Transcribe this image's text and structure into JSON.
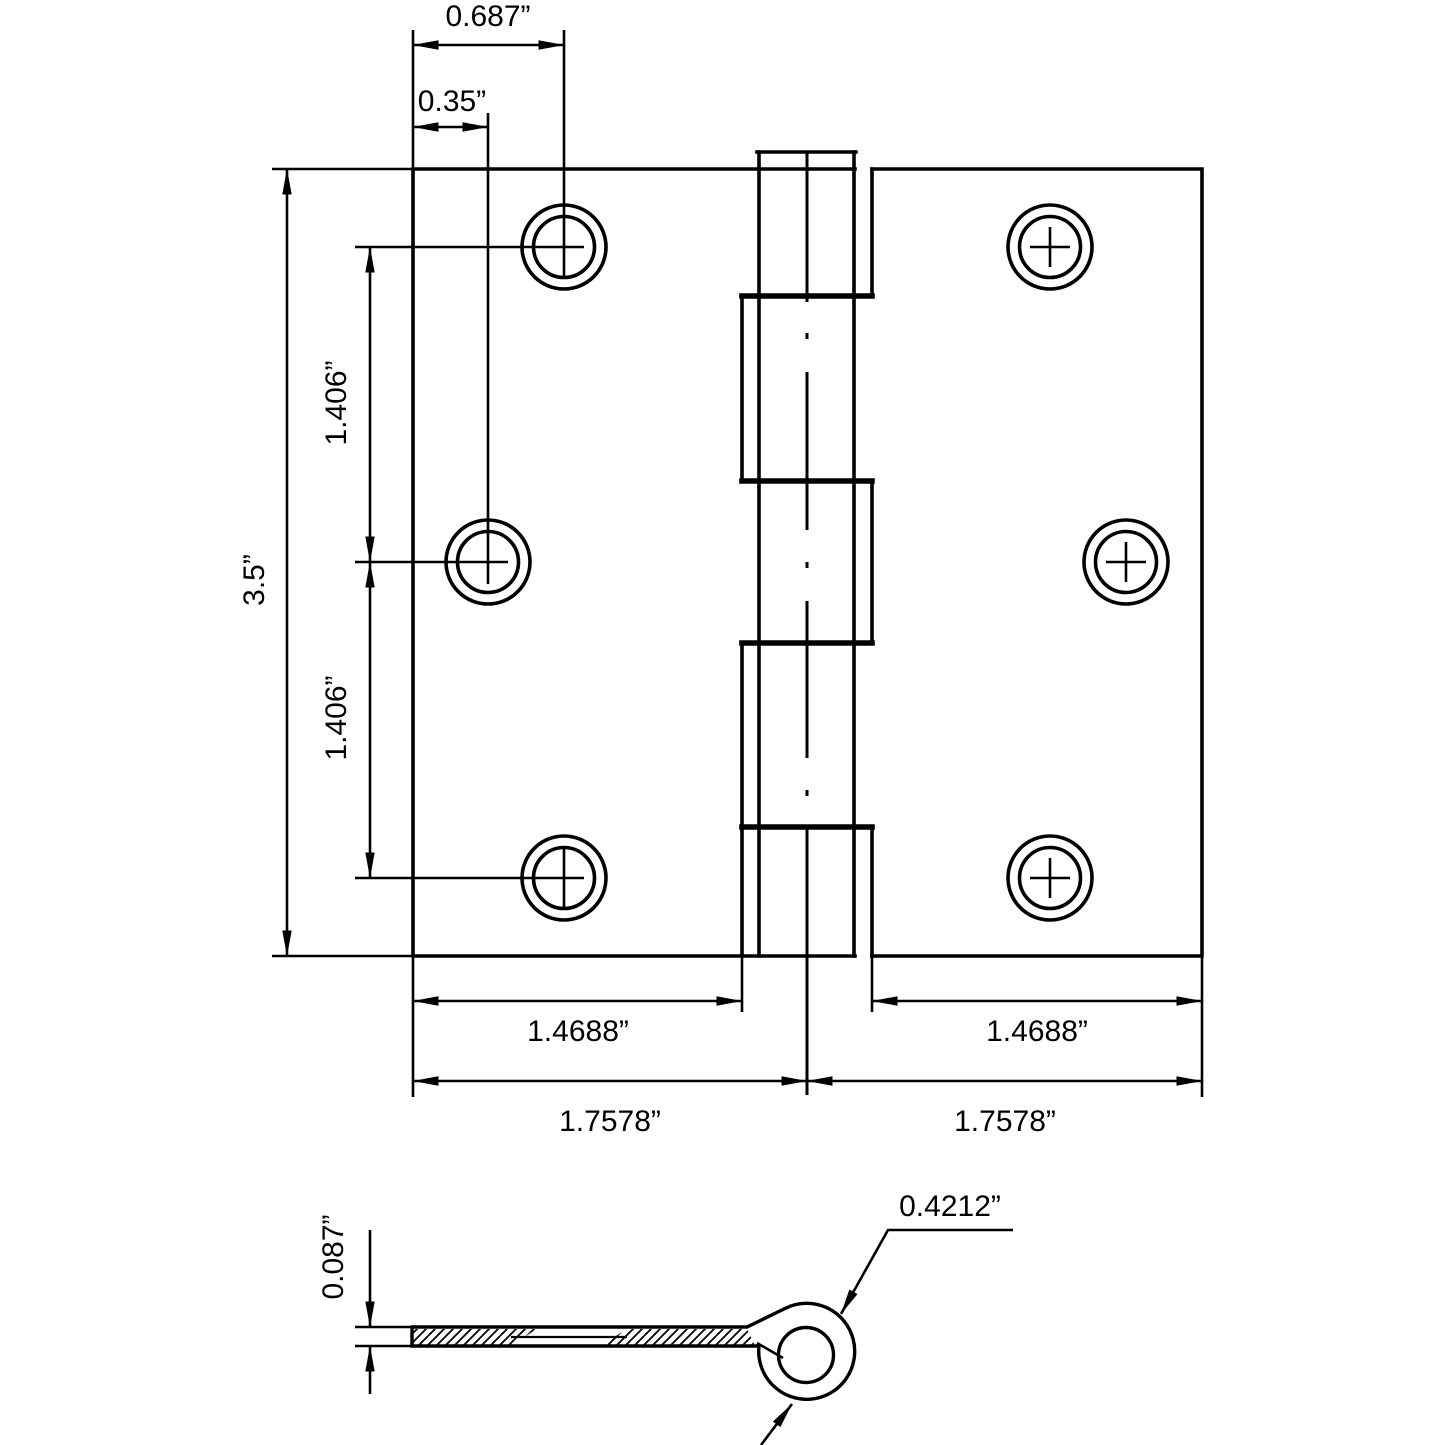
{
  "drawing": {
    "kind": "butt-hinge dimension drawing",
    "colors": {
      "line": "#000000",
      "background": "#ffffff"
    }
  },
  "front_view": {
    "dim_hole_offset_top": "0.687”",
    "dim_edge_inset": "0.35”",
    "dim_height": "3.5”",
    "dim_hole_spacing_upper": "1.406”",
    "dim_hole_spacing_lower": "1.406”",
    "dim_leaf_width_left": "1.4688”",
    "dim_leaf_width_right": "1.4688”",
    "dim_half_width_left": "1.7578”",
    "dim_half_width_right": "1.7578”"
  },
  "side_view": {
    "dim_thickness": "0.087”",
    "dim_knuckle_diameter": "0.4212”"
  }
}
